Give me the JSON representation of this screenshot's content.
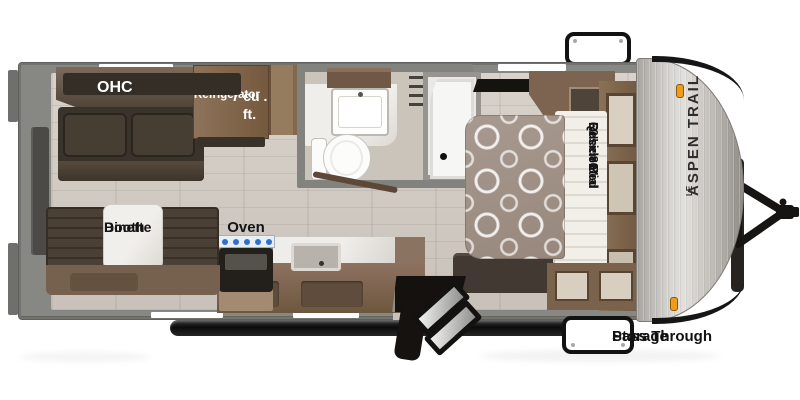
{
  "title": "Aspen Trail LE Travel Trailer Floor Plan",
  "labels": {
    "ohc": "OHC",
    "refrigerator": {
      "line1": "7 cu . ft.",
      "line2": "Refrigerator"
    },
    "booth_dinette": {
      "line1": "Booth",
      "line2": "Dinette"
    },
    "oven": "Oven",
    "bed": {
      "line1": "60\" x 80\"",
      "line2": "Residential",
      "line3": "Queen Bed"
    },
    "brand": {
      "name": "ASPEN TRAIL",
      "badge": "LE"
    },
    "pass_through_storage": {
      "line1": "Pass Through",
      "line2": "Storage"
    }
  },
  "colors": {
    "wall_gray": "#878784",
    "floor_plank": "#d3ccc4",
    "wood_cabinet": "#7d6551",
    "dark_upholstery": "#3c352d",
    "quilt_taupe": "#a3948a",
    "marble": "#eceae6",
    "front_cap_silver": "#c9c6c1",
    "frame_black": "#161616",
    "clearance_light_orange": "#ef9b1d",
    "burner_blue": "#2f6fd0",
    "label_black": "#141414",
    "label_white": "#ffffff"
  }
}
